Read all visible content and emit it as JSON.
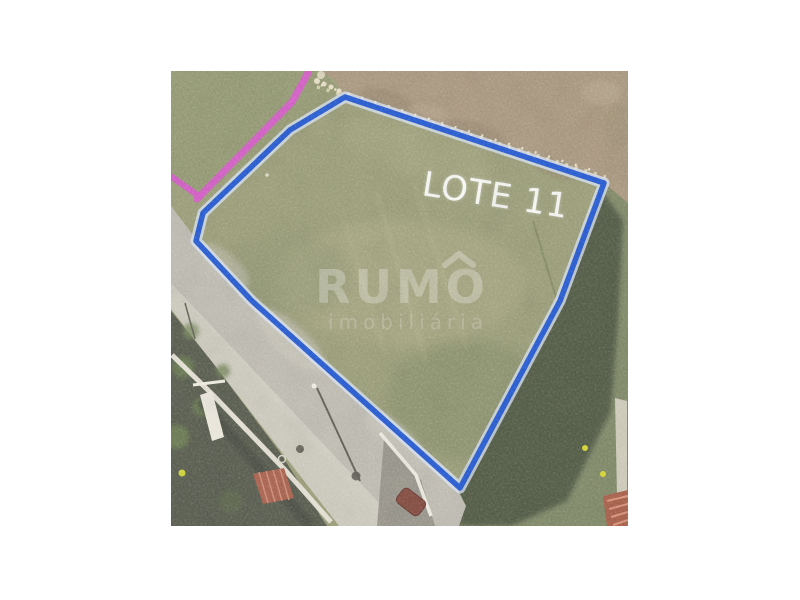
{
  "page": {
    "background": "#ffffff"
  },
  "photo": {
    "description": "aerial-photo-of-land-plot",
    "lot_label": "LOTE 11",
    "watermark": {
      "brand": "RUMO",
      "tagline": "imobiliária"
    },
    "colors": {
      "lot_boundary": "#1d50cf",
      "boundary_halo": "#d9e6f8",
      "survey_line": "#d351c5",
      "grass": "#949770",
      "dirt": "#a39077",
      "road": "#bab7ac",
      "trees": "#454e39",
      "roof": "#a3553f",
      "flowers": "#d6d428",
      "label_text": "#ffffff"
    }
  }
}
